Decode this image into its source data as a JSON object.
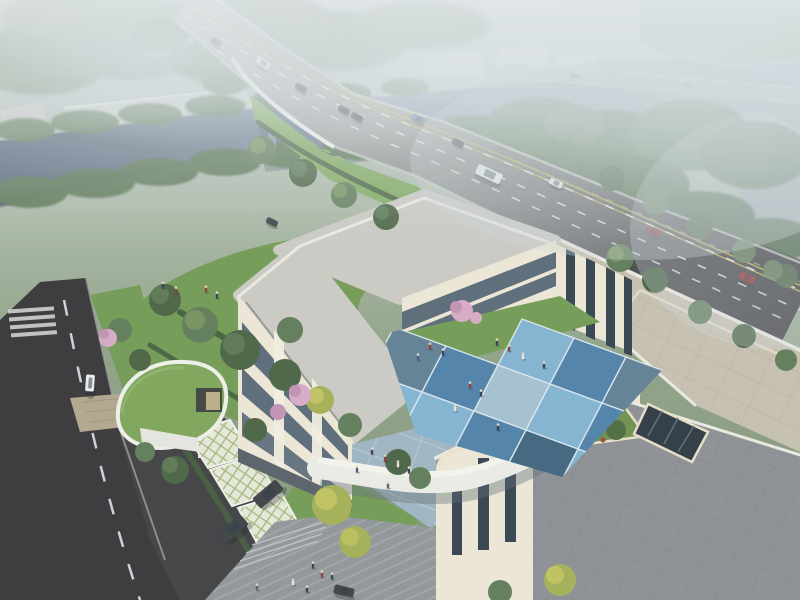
{
  "meta": {
    "title": "Aerial architectural rendering of a campus building beside a canal and highway overpass",
    "view": "bird's-eye perspective",
    "media_type": "photorealistic render"
  },
  "palette": {
    "hazeTop": "#c6ced3",
    "forestFar": "#7c9176",
    "forestMid": "#5d7954",
    "forestDark": "#46603f",
    "treeLight": "#7a965c",
    "treeYellow": "#a3ae52",
    "lawn": "#6f9a50",
    "lawnBright": "#7da85a",
    "water": "#6f8193",
    "waterDark": "#4e5f73",
    "roadLight": "#b0b2af",
    "roadDark": "#39393c",
    "roadLeft": "#323134",
    "laneWhite": "#f2f3f1",
    "laneYellow": "#c9b551",
    "laneGreen": "#a8b864",
    "sidewalk": "#c9cbc4",
    "roofGray": "#cbc9c3",
    "roofParapet": "#eceae2",
    "roofBeige": "#c6bfae",
    "terraceGray": "#8a8e92",
    "parapetCream": "#ece4cc",
    "facadeCream": "#efe8d6",
    "facadeShade": "#ded5bf",
    "windowGlass": "#46586a",
    "windowDark": "#2f3d4a",
    "courtLight": "#7fb2d0",
    "courtMid": "#4b7ea6",
    "courtDark": "#3c617c",
    "courtPale": "#a3bfd0",
    "courtSlate": "#5e7d93",
    "plazaBlue": "#9db4c0",
    "paveGray": "#8f9396",
    "grassRoof": "#7ca355",
    "latticeBg": "#e7ead9",
    "latticeLine": "#a3b377",
    "brick": "#b3a48a",
    "hedge": "#3f5a37",
    "blossom": "#d8a9c6",
    "blossomDeep": "#c28fb4",
    "carRed": "#8f2e2c",
    "carBlue": "#5a7cab",
    "carWhite": "#eceff0",
    "carDark": "#3a3d41",
    "gateWhite": "#eceae2"
  },
  "scene": {
    "landmarks": [
      "canal with tree-lined banks",
      "curved highway overpass with traffic",
      "distant flat bridge",
      "warehouse sheds beyond canal",
      "U-shaped three-story building",
      "blue checkerboard courtyard",
      "curved green-roof annex",
      "gated entrance with barrier",
      "grass-grid parking stalls",
      "roof terrace with planter and skylight"
    ],
    "vehicles": [
      {
        "name": "minibus",
        "x": 263,
        "y": 63,
        "w": 16,
        "h": 8,
        "rot": 35,
        "color": "carWhite",
        "op": 0.9
      },
      {
        "name": "car",
        "x": 216,
        "y": 42,
        "w": 11,
        "h": 6,
        "rot": 35,
        "color": "carDark",
        "op": 0.85
      },
      {
        "name": "car",
        "x": 301,
        "y": 88,
        "w": 12,
        "h": 6,
        "rot": 30,
        "color": "carDark",
        "op": 1
      },
      {
        "name": "car",
        "x": 344,
        "y": 110,
        "w": 12,
        "h": 6,
        "rot": 28,
        "color": "carDark",
        "op": 1
      },
      {
        "name": "car",
        "x": 357,
        "y": 117,
        "w": 12,
        "h": 6,
        "rot": 28,
        "color": "carDark",
        "op": 1
      },
      {
        "name": "car",
        "x": 418,
        "y": 119,
        "w": 13,
        "h": 6,
        "rot": 27,
        "color": "carBlue",
        "op": 1
      },
      {
        "name": "car",
        "x": 458,
        "y": 143,
        "w": 12,
        "h": 6,
        "rot": 26,
        "color": "carDark",
        "op": 1
      },
      {
        "name": "bus",
        "x": 489,
        "y": 174,
        "w": 27,
        "h": 11,
        "rot": 25,
        "color": "carWhite",
        "op": 1
      },
      {
        "name": "car",
        "x": 556,
        "y": 183,
        "w": 14,
        "h": 7,
        "rot": 25,
        "color": "carWhite",
        "op": 1
      },
      {
        "name": "car",
        "x": 654,
        "y": 232,
        "w": 15,
        "h": 7,
        "rot": 24,
        "color": "carRed",
        "op": 1
      },
      {
        "name": "car",
        "x": 747,
        "y": 278,
        "w": 16,
        "h": 8,
        "rot": 24,
        "color": "carRed",
        "op": 1
      },
      {
        "name": "car",
        "x": 575,
        "y": 76,
        "w": 10,
        "h": 4,
        "rot": 6,
        "color": "carDark",
        "op": 0.5
      },
      {
        "name": "car",
        "x": 628,
        "y": 80,
        "w": 10,
        "h": 4,
        "rot": 6,
        "color": "carWhite",
        "op": 0.5
      },
      {
        "name": "car",
        "x": 688,
        "y": 85,
        "w": 11,
        "h": 4,
        "rot": 7,
        "color": "carDark",
        "op": 0.45
      },
      {
        "name": "car",
        "x": 90,
        "y": 383,
        "w": 9,
        "h": 17,
        "rot": 4,
        "color": "carWhite",
        "op": 1
      },
      {
        "name": "car",
        "x": 344,
        "y": 591,
        "w": 20,
        "h": 9,
        "rot": 14,
        "color": "carDark",
        "op": 1
      },
      {
        "name": "suv",
        "x": 268,
        "y": 494,
        "w": 30,
        "h": 13,
        "rot": -40,
        "color": "carDark",
        "op": 1
      },
      {
        "name": "suv",
        "x": 233,
        "y": 529,
        "w": 30,
        "h": 13,
        "rot": -40,
        "color": "carDark",
        "op": 1
      },
      {
        "name": "car",
        "x": 272,
        "y": 222,
        "w": 12,
        "h": 6,
        "rot": 27,
        "color": "carDark",
        "op": 1
      }
    ],
    "people": [
      {
        "x": 497,
        "y": 343,
        "c": "#2e3a4a"
      },
      {
        "x": 509,
        "y": 349,
        "c": "#8f3434"
      },
      {
        "x": 523,
        "y": 357,
        "c": "#e8e8e8"
      },
      {
        "x": 544,
        "y": 366,
        "c": "#2e3a4a"
      },
      {
        "x": 470,
        "y": 386,
        "c": "#8f3434"
      },
      {
        "x": 481,
        "y": 394,
        "c": "#2e3a4a"
      },
      {
        "x": 455,
        "y": 409,
        "c": "#e8e8e8"
      },
      {
        "x": 498,
        "y": 428,
        "c": "#2e3a4a"
      },
      {
        "x": 430,
        "y": 347,
        "c": "#8f3434"
      },
      {
        "x": 443,
        "y": 353,
        "c": "#2e3a4a"
      },
      {
        "x": 418,
        "y": 358,
        "c": "#3a5a7a"
      },
      {
        "x": 372,
        "y": 452,
        "c": "#2e3a4a"
      },
      {
        "x": 385,
        "y": 459,
        "c": "#8f3434"
      },
      {
        "x": 398,
        "y": 465,
        "c": "#e8e8e8"
      },
      {
        "x": 409,
        "y": 471,
        "c": "#2e3a4a"
      },
      {
        "x": 357,
        "y": 470,
        "c": "#3a5a7a"
      },
      {
        "x": 388,
        "y": 486,
        "c": "#55606a"
      },
      {
        "x": 313,
        "y": 566,
        "c": "#2e3a4a"
      },
      {
        "x": 322,
        "y": 575,
        "c": "#8f3434"
      },
      {
        "x": 332,
        "y": 577,
        "c": "#2e3a4a"
      },
      {
        "x": 293,
        "y": 583,
        "c": "#e8e8e8"
      },
      {
        "x": 307,
        "y": 590,
        "c": "#2e3a4a"
      },
      {
        "x": 257,
        "y": 588,
        "c": "#55606a"
      },
      {
        "x": 206,
        "y": 290,
        "c": "#8f3434"
      },
      {
        "x": 217,
        "y": 296,
        "c": "#2e3a4a"
      },
      {
        "x": 163,
        "y": 286,
        "c": "#2e3a4a"
      },
      {
        "x": 176,
        "y": 291,
        "c": "#8f3434"
      }
    ]
  }
}
